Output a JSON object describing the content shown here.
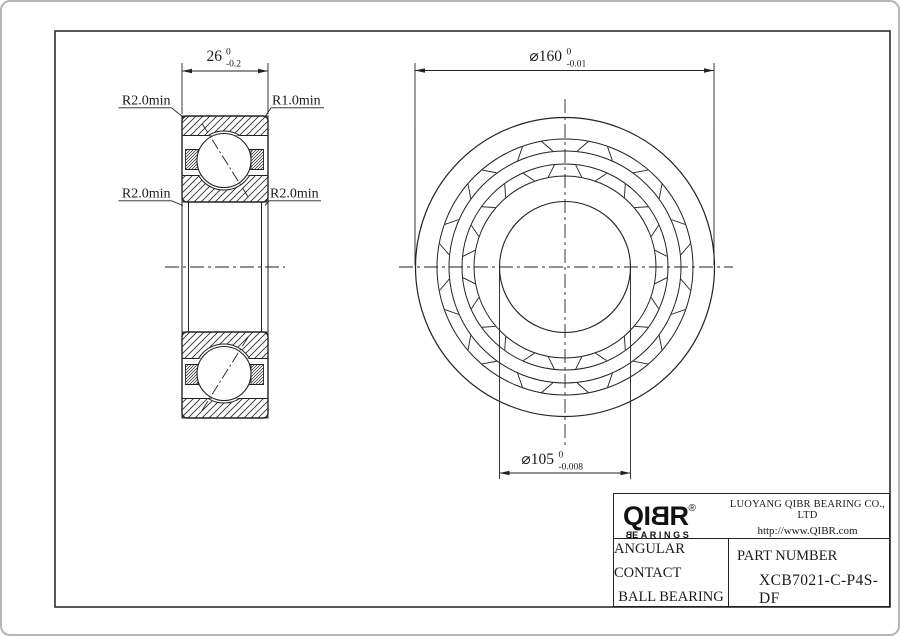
{
  "dimensions": {
    "width": {
      "text": "26",
      "sup": "0",
      "sub": "-0.2"
    },
    "outer_diameter": {
      "text": "⌀160",
      "sup": "0",
      "sub": "-0.01"
    },
    "bore_diameter": {
      "text": "⌀105",
      "sup": "0",
      "sub": "-0.008"
    }
  },
  "radius_labels": {
    "top_left": "R2.0min",
    "top_right": "R1.0min",
    "mid_left": "R2.0min",
    "mid_right": "R2.0min"
  },
  "title_block": {
    "logo": {
      "part1": "QI",
      "part2": "B",
      "part3": "R",
      "registered": "®",
      "sub_part1": "B",
      "sub_part2": "EARINGS"
    },
    "company": "LUOYANG QIBR BEARING CO., LTD",
    "website": "http://www.QIBR.com",
    "product_line1": "ANGULAR CONTACT",
    "product_line2": "BALL BEARING",
    "part_label": "PART NUMBER",
    "part_number": "XCB7021-C-P4S-DF"
  }
}
